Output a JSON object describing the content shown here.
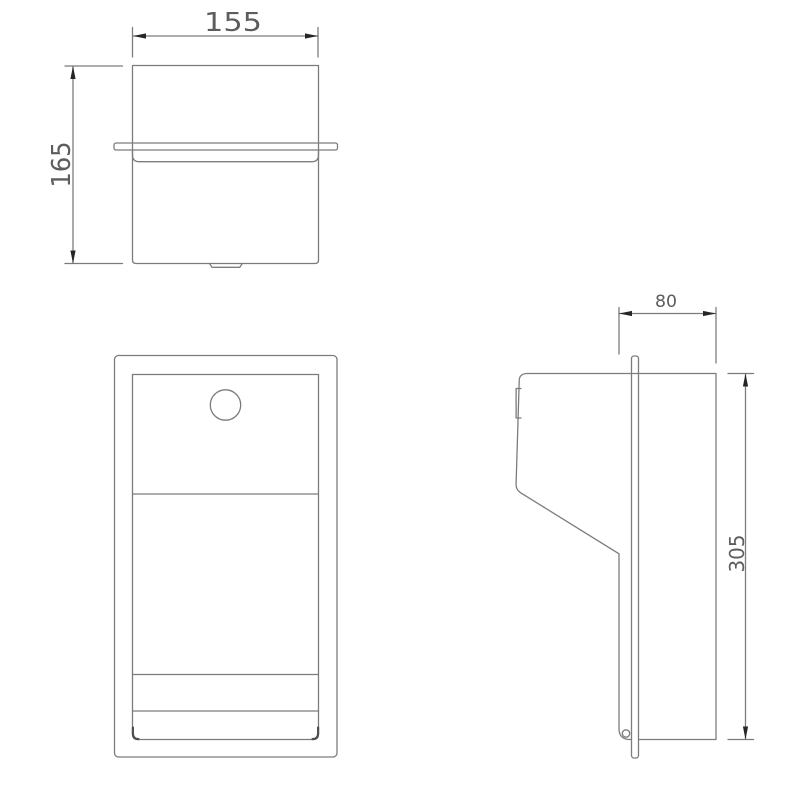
{
  "drawing": {
    "dimensions": {
      "top_view_width_mm": "155",
      "top_view_height_mm": "165",
      "side_view_depth_mm": "80",
      "side_view_height_mm": "305"
    },
    "colors": {
      "line": "#7c7c7c",
      "text": "#5d5d5d",
      "arrow": "#262626",
      "accent": "#4f4f4f",
      "background": "#ffffff"
    }
  }
}
